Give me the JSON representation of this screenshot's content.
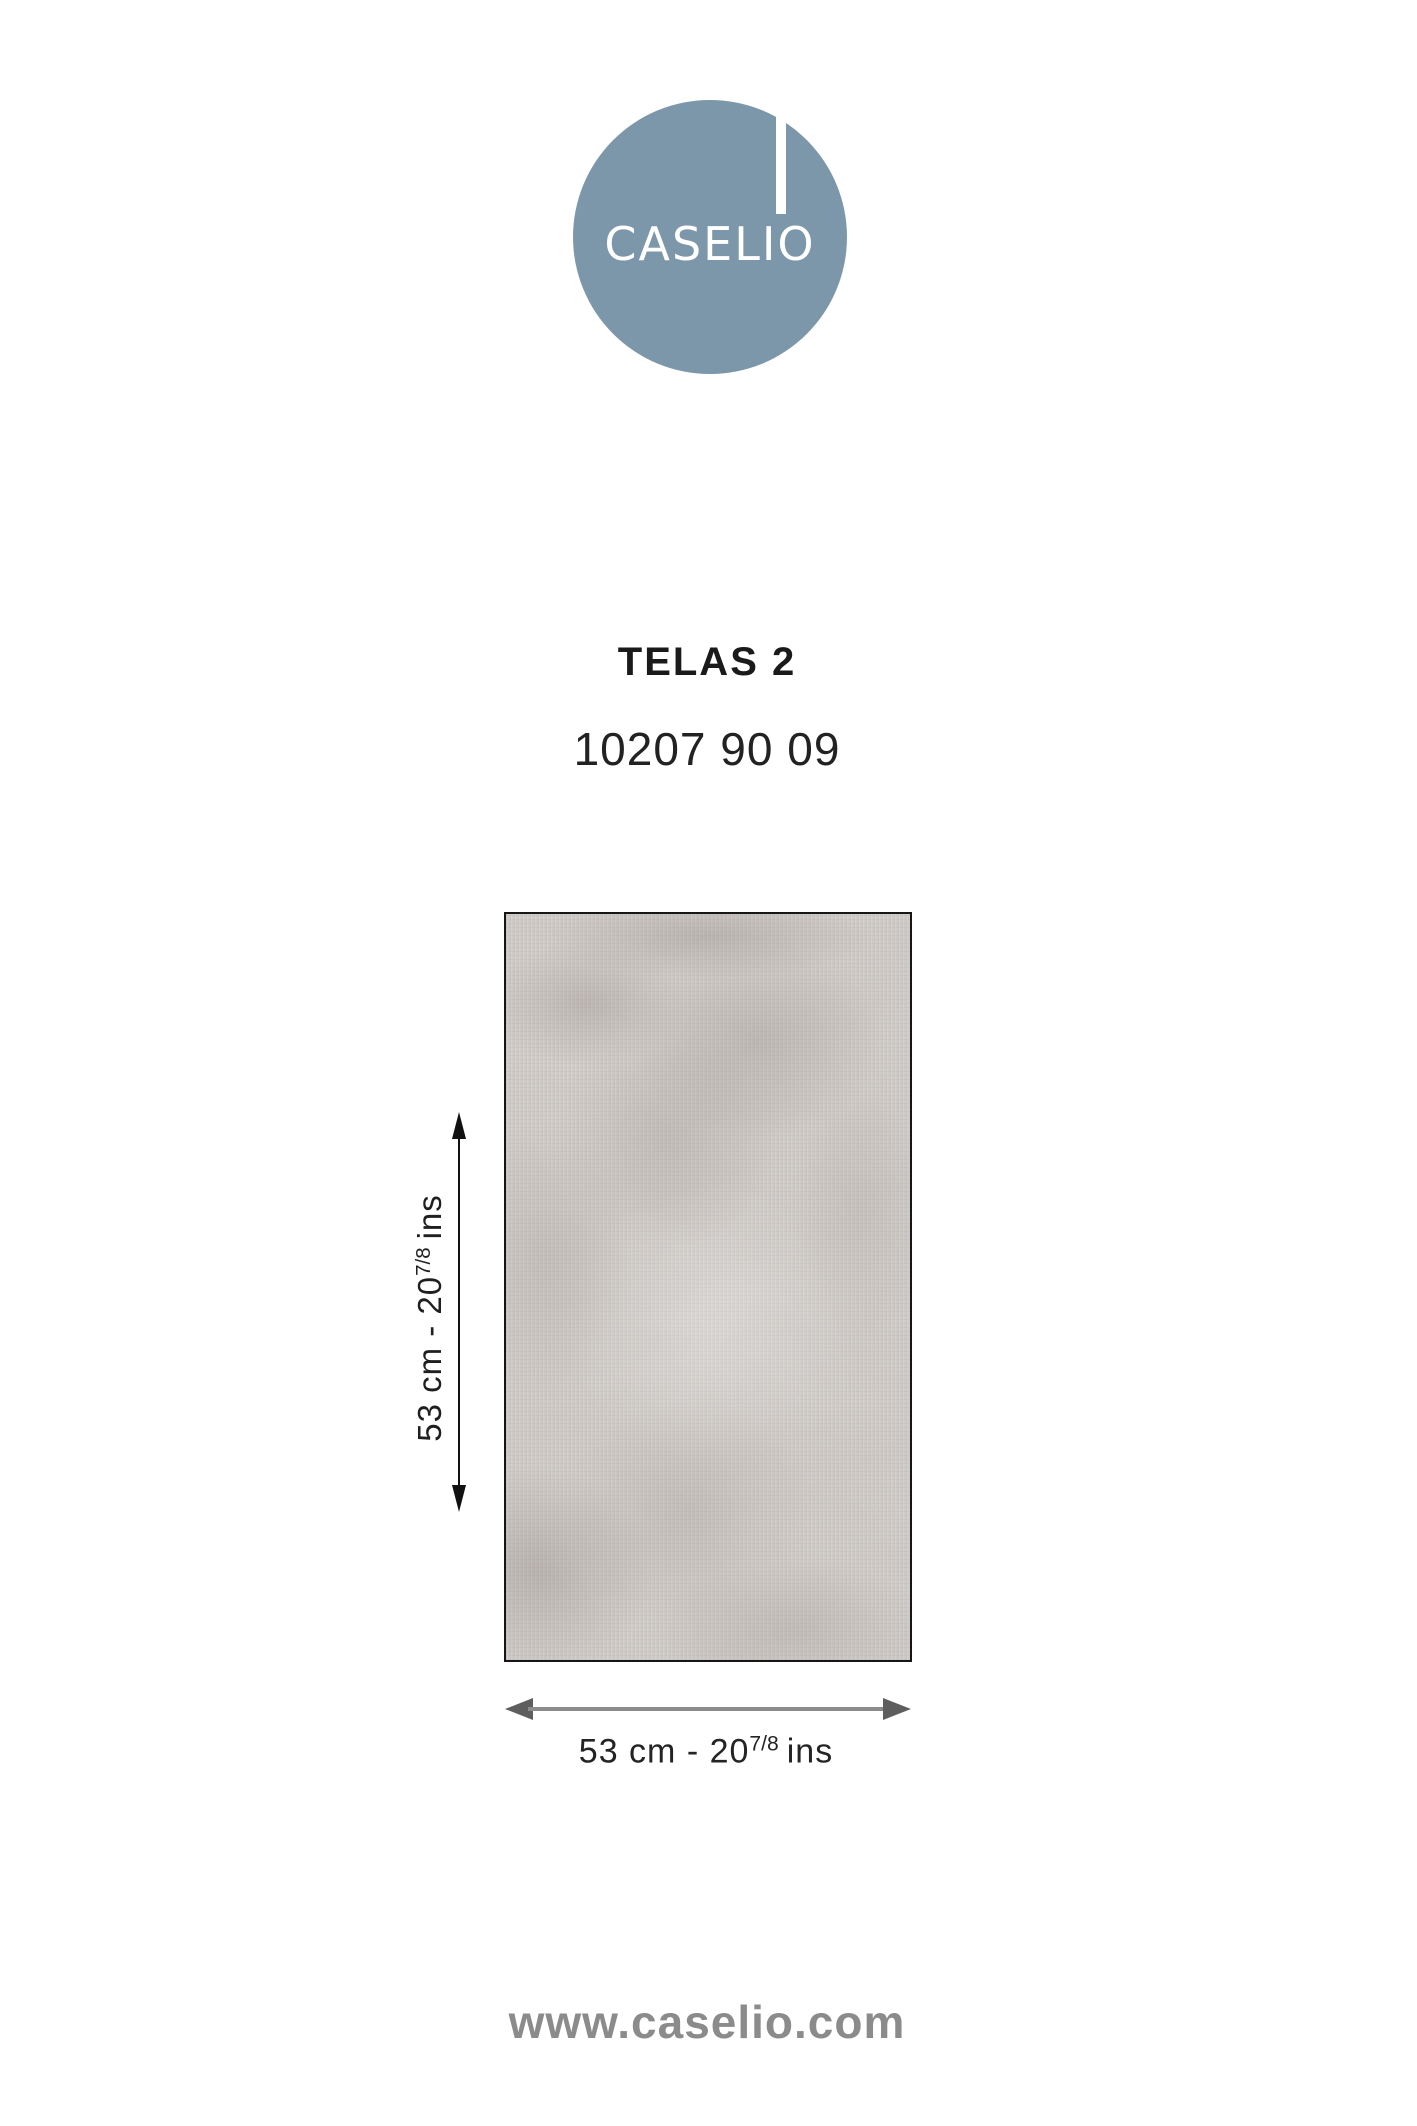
{
  "brand": {
    "logo_text": "CASELIO",
    "logo_circle_color": "#7d97aa",
    "website": "www.caselio.com"
  },
  "product": {
    "name": "TELAS 2",
    "reference": "10207 90 09"
  },
  "swatch": {
    "description": "plain textured wallpaper sample, mottled light grey linen weave",
    "base_color": "#d8d4d1",
    "border_color": "#161616"
  },
  "dimensions": {
    "height": {
      "main": "53 cm - 20",
      "sup": "7/8",
      "unit": "ins"
    },
    "width": {
      "main": "53 cm - 20",
      "sup": "7/8",
      "unit": "ins"
    }
  },
  "icons": {
    "vertical_arrow": "double-headed-vertical-arrow",
    "horizontal_arrow": "double-headed-horizontal-arrow"
  }
}
